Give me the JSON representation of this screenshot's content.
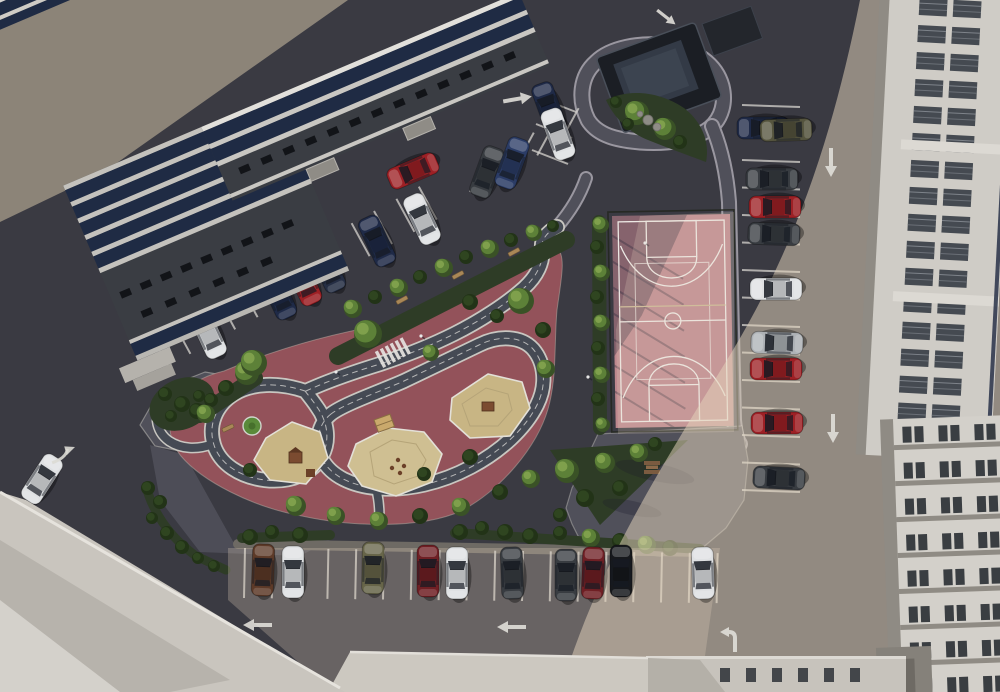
{
  "scene": {
    "kind": "aerial-3d-render",
    "description": "top-down view of residential courtyard with parking lots, playground with traffic-training track, basketball court, landscaping and surrounding apartment buildings",
    "lighting": "sunlit from upper-left, long diagonal shadow of buildings covers left half of courtyard"
  },
  "palette": {
    "asphalt": "#3a3a42",
    "ground_taupe": "#8c8478",
    "paving": "#50505a",
    "paving_light": "#8f897e",
    "curb": "#c9c6c0",
    "playground_red": "#93525a",
    "track": "#454a54",
    "track_edge": "#c9c7c1",
    "sand": "#c8b584",
    "sand2": "#cfbf92",
    "court_pink": "#bd878d",
    "court_line": "#ece8e4",
    "green_dark": "#2e3c26",
    "tree_base": "#3a5226",
    "tree_top": "#5d8138",
    "tree_hi": "#7fa04c",
    "bush_base": "#223317",
    "bush_top": "#2f4520",
    "white_bldg": "#cfccc6",
    "roof_gray": "#8f8b84",
    "roof_dark": "#3a3d43",
    "win_dark": "#1f2b44",
    "win_gray": "#3f444b",
    "paint_white": "#e2e0da"
  },
  "car_colors": {
    "white": "#dfe1e3",
    "silver": "#aeb2b6",
    "red": "#9d2025",
    "maroon": "#6f1f24",
    "darkblue": "#1f2a47",
    "navy": "#252e44",
    "blue": "#2b3c66",
    "darkgray": "#383c41",
    "black": "#17191d",
    "brown": "#5d3a28",
    "khaki": "#676549",
    "olive": "#55543e"
  },
  "cars": [
    [
      208,
      333,
      -25,
      "white"
    ],
    [
      278,
      294,
      -25,
      "darkblue"
    ],
    [
      303,
      280,
      -25,
      "red"
    ],
    [
      327,
      267,
      -25,
      "navy"
    ],
    [
      377,
      241,
      -25,
      "darkblue"
    ],
    [
      422,
      219,
      -25,
      "white"
    ],
    [
      413,
      171,
      -113,
      "red"
    ],
    [
      487,
      172,
      20,
      "darkgray"
    ],
    [
      512,
      163,
      20,
      "blue"
    ],
    [
      549,
      108,
      -20,
      "darkblue"
    ],
    [
      558,
      134,
      -20,
      "white"
    ],
    [
      763,
      128,
      -90,
      "darkblue"
    ],
    [
      786,
      130,
      -92,
      "olive"
    ],
    [
      772,
      179,
      -90,
      "darkgray"
    ],
    [
      775,
      207,
      -90,
      "red"
    ],
    [
      774,
      234,
      -88,
      "darkgray"
    ],
    [
      776,
      289,
      -90,
      "white"
    ],
    [
      777,
      343,
      -88,
      "silver"
    ],
    [
      776,
      369,
      -90,
      "red"
    ],
    [
      777,
      423,
      -90,
      "red"
    ],
    [
      779,
      478,
      -87,
      "darkgray"
    ],
    [
      263,
      570,
      2,
      "brown"
    ],
    [
      293,
      572,
      0,
      "white"
    ],
    [
      373,
      568,
      1,
      "khaki"
    ],
    [
      428,
      571,
      0,
      "maroon"
    ],
    [
      457,
      573,
      0,
      "white"
    ],
    [
      512,
      573,
      -2,
      "darkgray"
    ],
    [
      566,
      575,
      0,
      "darkgray"
    ],
    [
      593,
      573,
      2,
      "maroon"
    ],
    [
      621,
      571,
      0,
      "black"
    ],
    [
      703,
      573,
      -2,
      "white"
    ],
    [
      42,
      479,
      33,
      "white"
    ]
  ],
  "arrows": [
    [
      253,
      248,
      -12,
      "straight",
      1
    ],
    [
      517,
      99,
      -10,
      "straight",
      1
    ],
    [
      666,
      17,
      38,
      "straight",
      0.8
    ],
    [
      831,
      162,
      90,
      "straight",
      1
    ],
    [
      833,
      428,
      90,
      "straight",
      1
    ],
    [
      258,
      625,
      180,
      "straight",
      1
    ],
    [
      512,
      627,
      180,
      "straight",
      1
    ],
    [
      733,
      637,
      0,
      "turn",
      1
    ],
    [
      64,
      454,
      25,
      "curve",
      1
    ]
  ],
  "stall_rows": [
    {
      "x": 168,
      "y": 366,
      "dx": 22.4,
      "dy": -12.2,
      "n": 13,
      "lx": -18,
      "ly": -33
    },
    {
      "x": 470,
      "y": 192,
      "dx": 22.4,
      "dy": -12.2,
      "n": 5,
      "lx": 19,
      "ly": -35
    },
    {
      "x": 540,
      "y": 98,
      "dx": -4,
      "dy": 26,
      "n": 3,
      "lx": 36,
      "ly": 14
    },
    {
      "x": 742,
      "y": 105,
      "dx": 0,
      "dy": 27.5,
      "n": 15,
      "lx": 58,
      "ly": 2
    },
    {
      "x": 245,
      "y": 548,
      "dx": 27.8,
      "dy": 0.3,
      "n": 18,
      "lx": -1,
      "ly": 50
    }
  ],
  "trees": [
    [
      600,
      224,
      8,
      "t"
    ],
    [
      597,
      247,
      7,
      "b"
    ],
    [
      601,
      272,
      8,
      "t"
    ],
    [
      597,
      297,
      7,
      "b"
    ],
    [
      601,
      322,
      8,
      "t"
    ],
    [
      598,
      348,
      7,
      "b"
    ],
    [
      601,
      374,
      8,
      "t"
    ],
    [
      598,
      399,
      7,
      "b"
    ],
    [
      602,
      424,
      7,
      "t"
    ],
    [
      636,
      112,
      12,
      "t"
    ],
    [
      664,
      128,
      11,
      "t"
    ],
    [
      616,
      102,
      6,
      "b"
    ],
    [
      628,
      124,
      6,
      "b"
    ],
    [
      680,
      142,
      7,
      "b"
    ],
    [
      352,
      308,
      9,
      "t"
    ],
    [
      375,
      297,
      7,
      "b"
    ],
    [
      398,
      287,
      9,
      "t"
    ],
    [
      420,
      277,
      7,
      "b"
    ],
    [
      443,
      267,
      9,
      "t"
    ],
    [
      466,
      257,
      7,
      "b"
    ],
    [
      489,
      248,
      9,
      "t"
    ],
    [
      511,
      240,
      7,
      "b"
    ],
    [
      533,
      232,
      8,
      "t"
    ],
    [
      553,
      226,
      6,
      "b"
    ],
    [
      246,
      372,
      12,
      "t"
    ],
    [
      226,
      388,
      8,
      "b"
    ],
    [
      211,
      400,
      7,
      "b"
    ],
    [
      197,
      411,
      8,
      "b"
    ],
    [
      165,
      394,
      7,
      "b"
    ],
    [
      182,
      404,
      8,
      "b"
    ],
    [
      171,
      416,
      6,
      "b"
    ],
    [
      199,
      396,
      6,
      "b"
    ],
    [
      205,
      413,
      9,
      "t"
    ],
    [
      253,
      362,
      13,
      "t"
    ],
    [
      367,
      333,
      14,
      "t"
    ],
    [
      430,
      352,
      8,
      "t"
    ],
    [
      520,
      300,
      13,
      "t"
    ],
    [
      543,
      330,
      8,
      "b"
    ],
    [
      470,
      302,
      8,
      "b"
    ],
    [
      497,
      316,
      7,
      "b"
    ],
    [
      545,
      368,
      9,
      "t"
    ],
    [
      250,
      470,
      7,
      "b"
    ],
    [
      470,
      457,
      8,
      "b"
    ],
    [
      424,
      474,
      7,
      "b"
    ],
    [
      295,
      505,
      10,
      "t"
    ],
    [
      335,
      515,
      9,
      "t"
    ],
    [
      378,
      520,
      9,
      "t"
    ],
    [
      420,
      516,
      8,
      "b"
    ],
    [
      460,
      506,
      9,
      "t"
    ],
    [
      500,
      492,
      8,
      "b"
    ],
    [
      530,
      478,
      9,
      "t"
    ],
    [
      148,
      488,
      7,
      "b"
    ],
    [
      160,
      502,
      7,
      "b"
    ],
    [
      152,
      518,
      6,
      "b"
    ],
    [
      167,
      533,
      7,
      "b"
    ],
    [
      182,
      547,
      7,
      "b"
    ],
    [
      198,
      558,
      6,
      "b"
    ],
    [
      214,
      566,
      6,
      "b"
    ],
    [
      566,
      470,
      12,
      "t"
    ],
    [
      604,
      462,
      10,
      "t"
    ],
    [
      638,
      452,
      9,
      "t"
    ],
    [
      585,
      498,
      9,
      "b"
    ],
    [
      620,
      488,
      8,
      "b"
    ],
    [
      655,
      444,
      7,
      "b"
    ],
    [
      560,
      515,
      7,
      "b"
    ],
    [
      250,
      537,
      8,
      "b"
    ],
    [
      272,
      532,
      7,
      "b"
    ],
    [
      300,
      535,
      8,
      "b"
    ],
    [
      460,
      532,
      8,
      "b"
    ],
    [
      482,
      528,
      7,
      "b"
    ],
    [
      505,
      532,
      8,
      "b"
    ],
    [
      530,
      536,
      8,
      "b"
    ],
    [
      560,
      533,
      7,
      "b"
    ],
    [
      590,
      537,
      9,
      "t"
    ],
    [
      620,
      541,
      8,
      "b"
    ],
    [
      646,
      544,
      9,
      "t"
    ],
    [
      670,
      548,
      8,
      "b"
    ]
  ],
  "benches": [
    [
      402,
      300,
      -28
    ],
    [
      458,
      275,
      -28
    ],
    [
      514,
      252,
      -28
    ],
    [
      228,
      428,
      -25
    ]
  ],
  "picnic_table": [
    652,
    467
  ],
  "figures": [
    [
      336,
      372
    ],
    [
      588,
      377
    ],
    [
      645,
      243
    ],
    [
      421,
      336
    ]
  ],
  "rocks": [
    [
      648,
      120,
      5
    ],
    [
      657,
      127,
      4
    ],
    [
      640,
      114,
      3
    ]
  ]
}
